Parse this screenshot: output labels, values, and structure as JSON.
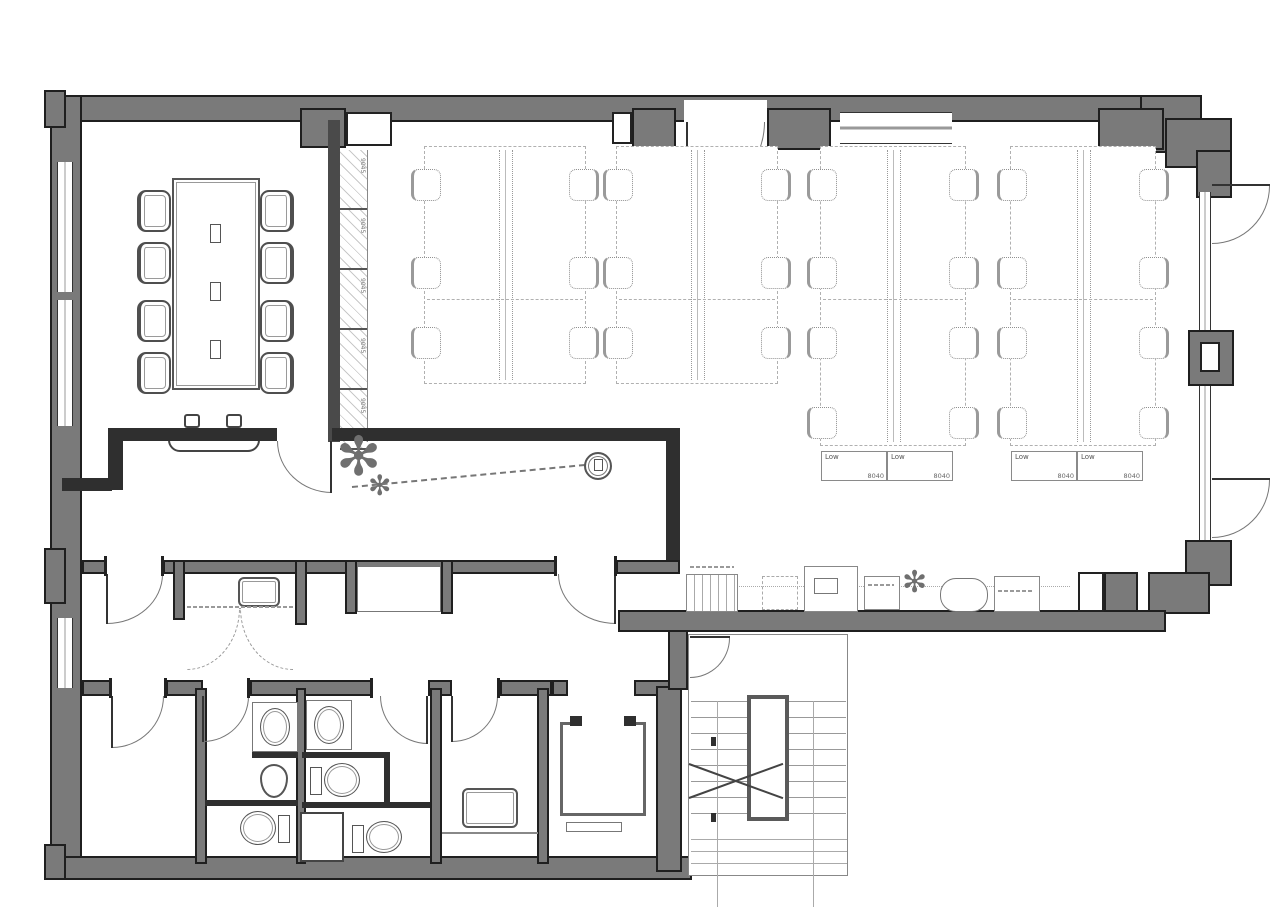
{
  "drawing": {
    "kind": "architectural floor plan, office tenant floor",
    "colors": {
      "wall_fill": "#7a7a7a",
      "wall_edge": "#1f1f1f",
      "partition_dark": "#2f2f2f",
      "thin_line": "#888888",
      "background": "#ffffff"
    }
  },
  "labels": {
    "low_cabinet": "Low",
    "desk_dimension": "8040",
    "locker_dimension": "9045"
  },
  "furniture": {
    "meeting_chairs": 8,
    "locker_cells": 5,
    "desk_islands": [
      {
        "rows": 3,
        "low_cabinet": false
      },
      {
        "rows": 3,
        "low_cabinet": false
      },
      {
        "rows": 4,
        "low_cabinet": true
      },
      {
        "rows": 4,
        "low_cabinet": true
      }
    ],
    "low_cabinet": {
      "labels": [
        "Low",
        "Low"
      ],
      "dims": [
        "8040",
        "8040"
      ]
    }
  },
  "fixtures": [
    "conference-table",
    "meeting-chair",
    "side-bench",
    "desk-island",
    "task-chair",
    "storage-locker-run",
    "plant",
    "ceiling-symbol",
    "kitchen-sink",
    "bifold-door",
    "wash-basin",
    "urinal",
    "toilet",
    "duct-shaft",
    "mop-sink",
    "elevator",
    "staircase",
    "shelf-unit",
    "copier",
    "printer-stand",
    "round-table",
    "equipment-cabinet"
  ],
  "doors": {
    "swing_doors": 12,
    "bifold_doors": 1,
    "elevator_doors": 1
  }
}
